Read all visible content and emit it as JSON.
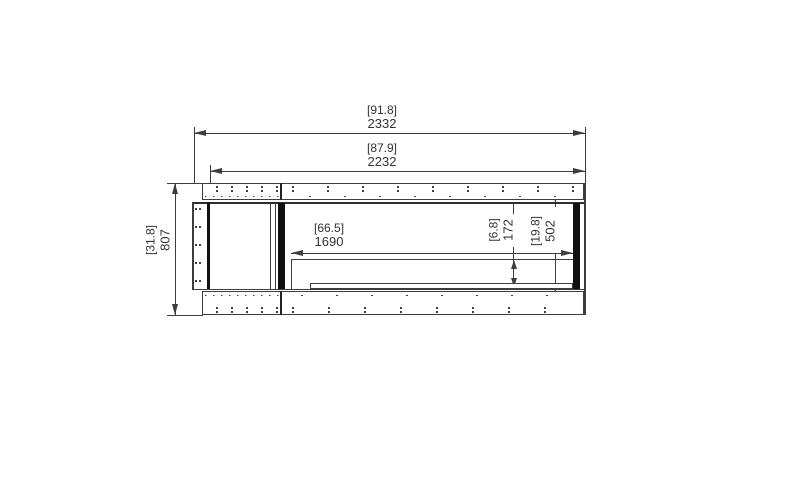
{
  "drawing": {
    "title": "fireplace-firebox-front-elevation",
    "colors": {
      "line": "#3d3d3d",
      "black_bar": "#101010",
      "text": "#333333",
      "background": "#ffffff"
    },
    "dims": {
      "overall_width": {
        "inches": "[91.8]",
        "mm": "2332"
      },
      "front_width": {
        "inches": "[87.9]",
        "mm": "2232"
      },
      "burner_width": {
        "inches": "[66.5]",
        "mm": "1690"
      },
      "overall_height": {
        "inches": "[31.8]",
        "mm": "807"
      },
      "opening_height": {
        "inches": "[19.8]",
        "mm": "502"
      },
      "deck_height": {
        "inches": "[6.8]",
        "mm": "172"
      }
    }
  }
}
